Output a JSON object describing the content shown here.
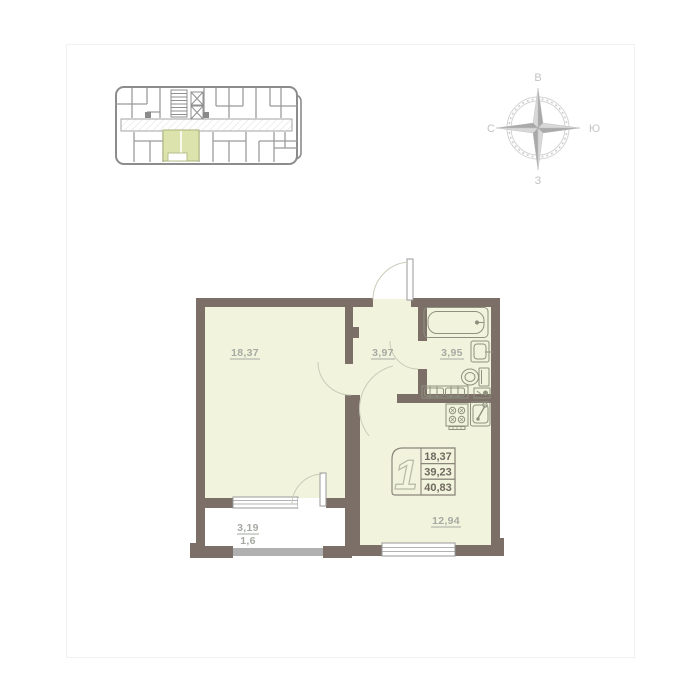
{
  "compass": {
    "east_label": "В",
    "south_label": "Ю",
    "west_label": "З",
    "north_label": "С"
  },
  "plan": {
    "rooms": {
      "living": {
        "area": "18,37"
      },
      "hall": {
        "area": "3,97"
      },
      "bathroom": {
        "area": "3,95"
      },
      "kitchen": {
        "area": "12,94"
      },
      "balcony": {
        "area": "3,19",
        "reduced_area": "1,6"
      }
    },
    "info_box": {
      "rooms_count": "1",
      "values": [
        "18,37",
        "39,23",
        "40,83"
      ]
    }
  },
  "colors": {
    "wall": "#7b6f68",
    "floor": "#f1f3dc",
    "mini_plan_highlight": "#dce3ad",
    "label_text": "#a6aaa2",
    "info_text": "#6f695f",
    "compass_gray": "#c3c3c3",
    "window_frame": "#9a9a9a"
  }
}
